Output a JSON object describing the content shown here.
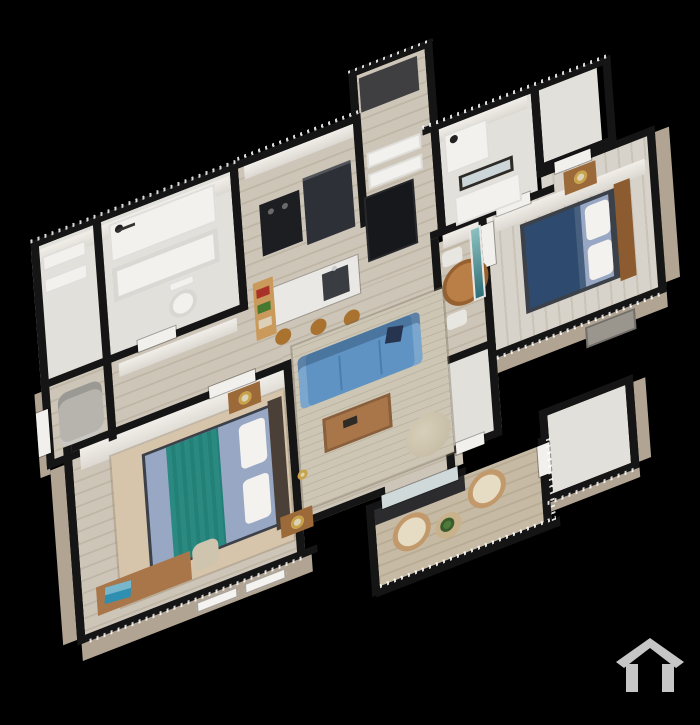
{
  "scene": {
    "description": "3D isometric cutaway floor plan rendering of a furnished two-bedroom apartment on a black background",
    "view": "axonometric top-down cutaway",
    "watermark_icon": "house-logo-icon"
  },
  "palette": {
    "background": "#000000",
    "wall_cap": "#151515",
    "exterior_wall": "#b2a493",
    "pale_floor": "#e2e0db",
    "wood_floor": "#cdc5b8",
    "wood_gap": "#c0b6a6",
    "wood_floor_light": "#d8d3ca",
    "wood_gap_light": "#cac4b8",
    "deck": "#c6baa5",
    "deck_gap": "#b9ac95",
    "rug_living": "#cdc6b5",
    "rug_bedroom": "#d6c5ab",
    "sofa": "#5f93c3",
    "sofa_seam": "#4a7eae",
    "pillow_navy": "#273450",
    "coffee_table": "#a9764a",
    "dining_table": "#b97f47",
    "dining_table_edge": "#96602f",
    "stool": "#a9722f",
    "shelf_wood": "#c99a5b",
    "item_red": "#a83228",
    "item_green": "#44792f",
    "item_tan": "#ddd0b8",
    "fridge": "#2d3036",
    "appliance": "#1d1e21",
    "pantry": "#17181b",
    "island": "#eae8e4",
    "sink": "#393c40",
    "faucet": "#c9c9c9",
    "bed_frame": "#3c4149",
    "bed_sheet": "#98a7c3",
    "bed_teal": "#2a8a81",
    "pillow_white": "#f3f2ef",
    "headboard_dark": "#4a4037",
    "headboard_wood": "#8c5c30",
    "nightstand": "#9c6a38",
    "lamp_gold": "#c8a24b",
    "lamp_shade": "#ddd2b6",
    "blanket_navy": "#2e4a6e",
    "armchair": "#b7b4ae",
    "chair_white": "#e8e6e1",
    "wicker": "#c2996a",
    "wicker_fill": "#e6dcc4",
    "balcony_table": "#c8b28c",
    "plant": "#4e7a3a",
    "laptop": "#2f8fb0",
    "desk_wood": "#a9764a",
    "door": "#f1f0ec",
    "glass_door": "#cfd9da",
    "mirror": "#ccd5d7",
    "art_top": "#8cc0c0",
    "art_bottom": "#2e6f78",
    "ac_unit": "#9a968e",
    "fixture_white": "#f2f1ee",
    "tan_window": "#f4f3f0",
    "railing": "#141414",
    "logo": "#c6c6c6"
  },
  "floor_plan": {
    "rooms": [
      {
        "id": "laundry-closet",
        "label": "Laundry / Storage",
        "furniture": [
          "white shelves"
        ]
      },
      {
        "id": "bathroom",
        "label": "Bathroom",
        "furniture": [
          "shower with head",
          "bathtub",
          "toilet"
        ]
      },
      {
        "id": "entry-hall",
        "label": "Entry Hall",
        "furniture": [
          "gray armchair",
          "front door"
        ]
      },
      {
        "id": "hallway",
        "label": "Hallway",
        "furniture": [
          "dark floor mat",
          "linen shelves"
        ]
      },
      {
        "id": "kitchen",
        "label": "Kitchen",
        "furniture": [
          "refrigerator",
          "stove",
          "pantry cabinet",
          "island with sink",
          "3 bar stools",
          "open shelf with red and green items"
        ]
      },
      {
        "id": "bathroom-2",
        "label": "Bathroom 2",
        "furniture": [
          "shower",
          "vanity",
          "framed mirror"
        ]
      },
      {
        "id": "closet",
        "label": "Closet",
        "furniture": []
      },
      {
        "id": "living-room",
        "label": "Living Room",
        "furniture": [
          "blue sofa with navy pillow",
          "wood coffee table",
          "pouf chair",
          "striped rug",
          "gold floor lamp"
        ]
      },
      {
        "id": "dining-area",
        "label": "Dining Area",
        "furniture": [
          "round wood table",
          "2 white chairs",
          "teal wall art"
        ]
      },
      {
        "id": "bedroom-2",
        "label": "Bedroom 2",
        "furniture": [
          "bed with navy blanket",
          "wood headboard",
          "nightstand with lamp",
          "exterior unit"
        ]
      },
      {
        "id": "master-bedroom",
        "label": "Master Bedroom",
        "furniture": [
          "bed with teal striped cover",
          "2 nightstands with gold lamps",
          "desk with teal laptop",
          "chair",
          "tan area rug",
          "2 exterior windows"
        ]
      },
      {
        "id": "hall-closet",
        "label": "Hall Closet",
        "furniture": [
          "louvered door"
        ]
      },
      {
        "id": "balcony",
        "label": "Balcony",
        "furniture": [
          "2 wicker chairs",
          "side table with plant",
          "dark railing",
          "sliding glass door"
        ]
      },
      {
        "id": "storage-closet",
        "label": "Storage",
        "furniture": []
      }
    ]
  },
  "logo": {
    "icon": "house-logo-icon",
    "position": "bottom-right"
  }
}
